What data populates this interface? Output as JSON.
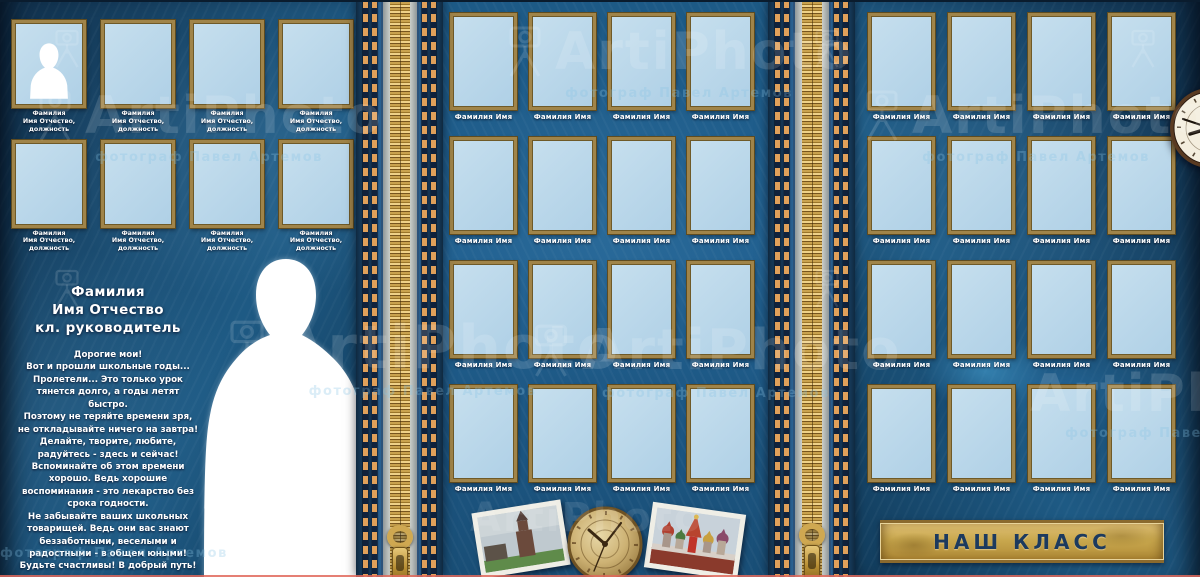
{
  "watermark": {
    "brand": "ArtiPhoto",
    "subtitle": "фотограф Павел Артемов"
  },
  "left_page": {
    "frame_count": 8,
    "frame_label_lines": [
      "Фамилия",
      "Имя Отчество,",
      "должность"
    ],
    "teacher_title_lines": [
      "Фамилия",
      "Имя Отчество",
      "кл. руководитель"
    ],
    "message_lines": [
      "Дорогие мои!",
      "Вот и прошли школьные годы...",
      "Пролетели... Это только урок",
      "тянется долго, а годы летят",
      "быстро.",
      "Поэтому не теряйте времени зря,",
      "не откладывайте ничего на завтра!",
      "Делайте, творите, любите,",
      "радуйтесь - здесь и сейчас!",
      "Вспоминайте  об этом времени",
      "хорошо.  Ведь хорошие",
      "воспоминания - это лекарство без",
      "срока годности.",
      "Не забывайте ваших школьных",
      "товарищей. Ведь  они вас знают",
      "беззаботными,  веселыми  и",
      "радостными  -  в общем юными!",
      "Будьте счастливы! В добрый путь!"
    ]
  },
  "middle_page": {
    "frame_count": 16,
    "frame_label": "Фамилия Имя"
  },
  "right_page": {
    "frame_count": 16,
    "frame_label": "Фамилия Имя",
    "banner_label": "НАШ КЛАСС"
  },
  "icons": {
    "watermark_icon": "camera-on-tripod-icon",
    "clock": "wall-clock",
    "compass": "brass-compass-clock",
    "zipper": "gold-zipper",
    "photo_left": "kremlin-tower-photo",
    "photo_right": "st-basils-cathedral-photo",
    "silhouette_small": "person-head-shoulders-silhouette",
    "silhouette_large": "woman-silhouette"
  },
  "colors": {
    "denim_blue": "#1e5a84",
    "frame_fill": "#b9d7ea",
    "frame_border": "#a08449",
    "zipper_gold": "#c9a24e",
    "banner_gold": "#c9a84e",
    "banner_text": "#1c3a5e",
    "label_text": "#ffffff",
    "bottom_line_red": "#e0685c"
  }
}
